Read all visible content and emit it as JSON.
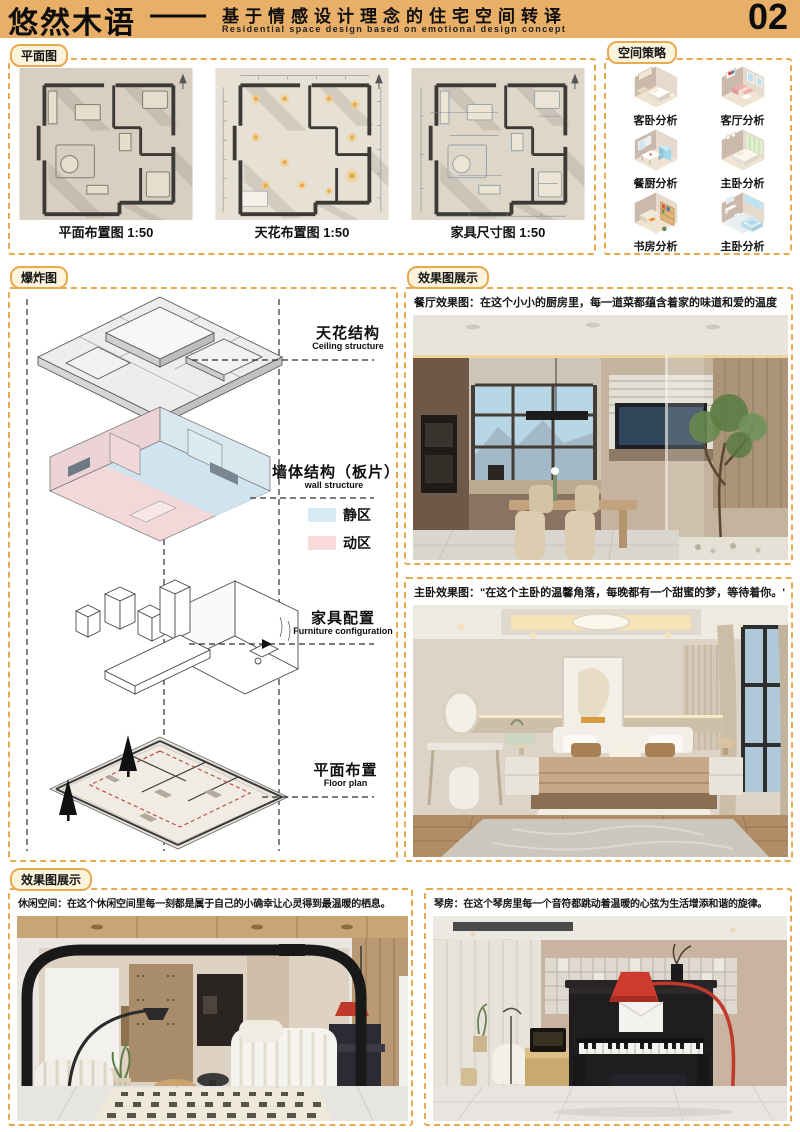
{
  "header": {
    "title": "悠然木语",
    "divider": "——",
    "subtitle": "基于情感设计理念的住宅空间转译",
    "subtitle_en": "Residential space design based on emotional design concept",
    "page_number": "02"
  },
  "colors": {
    "header_bg": "#E8AF68",
    "dashed_border": "#E9A94E",
    "tag_bg": "#FBF3DC",
    "quiet_zone": "#D6EAF5",
    "active_zone": "#F8DADA"
  },
  "floor_plans": {
    "tag": "平面图",
    "items": [
      {
        "caption": "平面布置图 1:50"
      },
      {
        "caption": "天花布置图 1:50"
      },
      {
        "caption": "家具尺寸图 1:50"
      }
    ]
  },
  "space_strategy": {
    "tag": "空间策略",
    "items": [
      {
        "label": "客卧分析",
        "icon": "guest-bedroom-isometric-icon"
      },
      {
        "label": "客厅分析",
        "icon": "living-room-isometric-icon"
      },
      {
        "label": "餐厨分析",
        "icon": "dining-kitchen-isometric-icon"
      },
      {
        "label": "主卧分析",
        "icon": "master-bedroom-isometric-icon"
      },
      {
        "label": "书房分析",
        "icon": "study-room-isometric-icon"
      },
      {
        "label": "主卧分析",
        "icon": "master-bathroom-isometric-icon"
      }
    ]
  },
  "exploded_view": {
    "tag": "爆炸图",
    "layers": [
      {
        "zh": "天花结构",
        "en": "Ceiling structure"
      },
      {
        "zh": "墙体结构（板片）",
        "en": "wall structure"
      },
      {
        "zh": "家具配置",
        "en": "Furniture configuration"
      },
      {
        "zh": "平面布置",
        "en": "Floor plan"
      }
    ],
    "legend": [
      {
        "label": "静区",
        "color": "#D6EAF5"
      },
      {
        "label": "动区",
        "color": "#F8DADA"
      }
    ]
  },
  "renders_right": {
    "tag": "效果图展示",
    "dining_caption": "餐厅效果图：在这个小小的厨房里，每一道菜都蕴含着家的味道和爱的温度",
    "bedroom_caption": "主卧效果图：\"在这个主卧的温馨角落，每晚都有一个甜蜜的梦，等待着你。\""
  },
  "renders_bottom": {
    "tag": "效果图展示",
    "leisure_caption": "休闲空间：在这个休闲空间里每一刻都是属于自己的小确幸让心灵得到最温暖的栖息。",
    "piano_caption": "琴房：在这个琴房里每一个音符都跳动着温暖的心弦为生活增添和谐的旋律。"
  }
}
